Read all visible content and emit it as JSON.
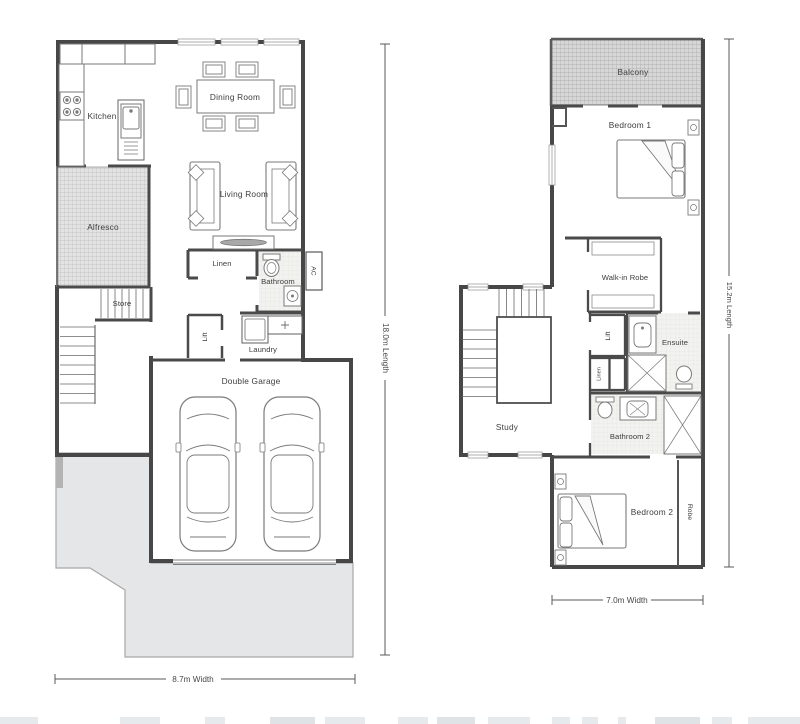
{
  "ground_floor": {
    "rooms": {
      "kitchen": "Kitchen",
      "dining_room": "Dining Room",
      "living_room": "Living Room",
      "alfresco": "Alfresco",
      "store": "Store",
      "linen": "Linen",
      "bathroom": "Bathroom",
      "ac": "AC",
      "lift": "Lift",
      "laundry": "Laundry",
      "double_garage": "Double Garage"
    },
    "dimensions": {
      "length": "18.0m Length",
      "width": "8.7m Width"
    }
  },
  "first_floor": {
    "rooms": {
      "balcony": "Balcony",
      "bedroom1": "Bedroom 1",
      "walk_in_robe": "Walk-in Robe",
      "lift": "Lift",
      "linen": "Linen",
      "ensuite": "Ensuite",
      "study": "Study",
      "bathroom2": "Bathroom 2",
      "bedroom2": "Bedroom 2",
      "robe": "Robe"
    },
    "dimensions": {
      "length": "15.2m Length",
      "width": "7.0m Width"
    }
  },
  "colors": {
    "wall": "#474747",
    "furniture_line": "#7a7a7a",
    "balcony_hatch_bg": "#d7d7d7",
    "alfresco_hatch_bg": "#e3e3e3",
    "tile_bg": "#f2f2f0",
    "driveway_fill": "#e5e6e8",
    "text": "#3d3d3d"
  }
}
